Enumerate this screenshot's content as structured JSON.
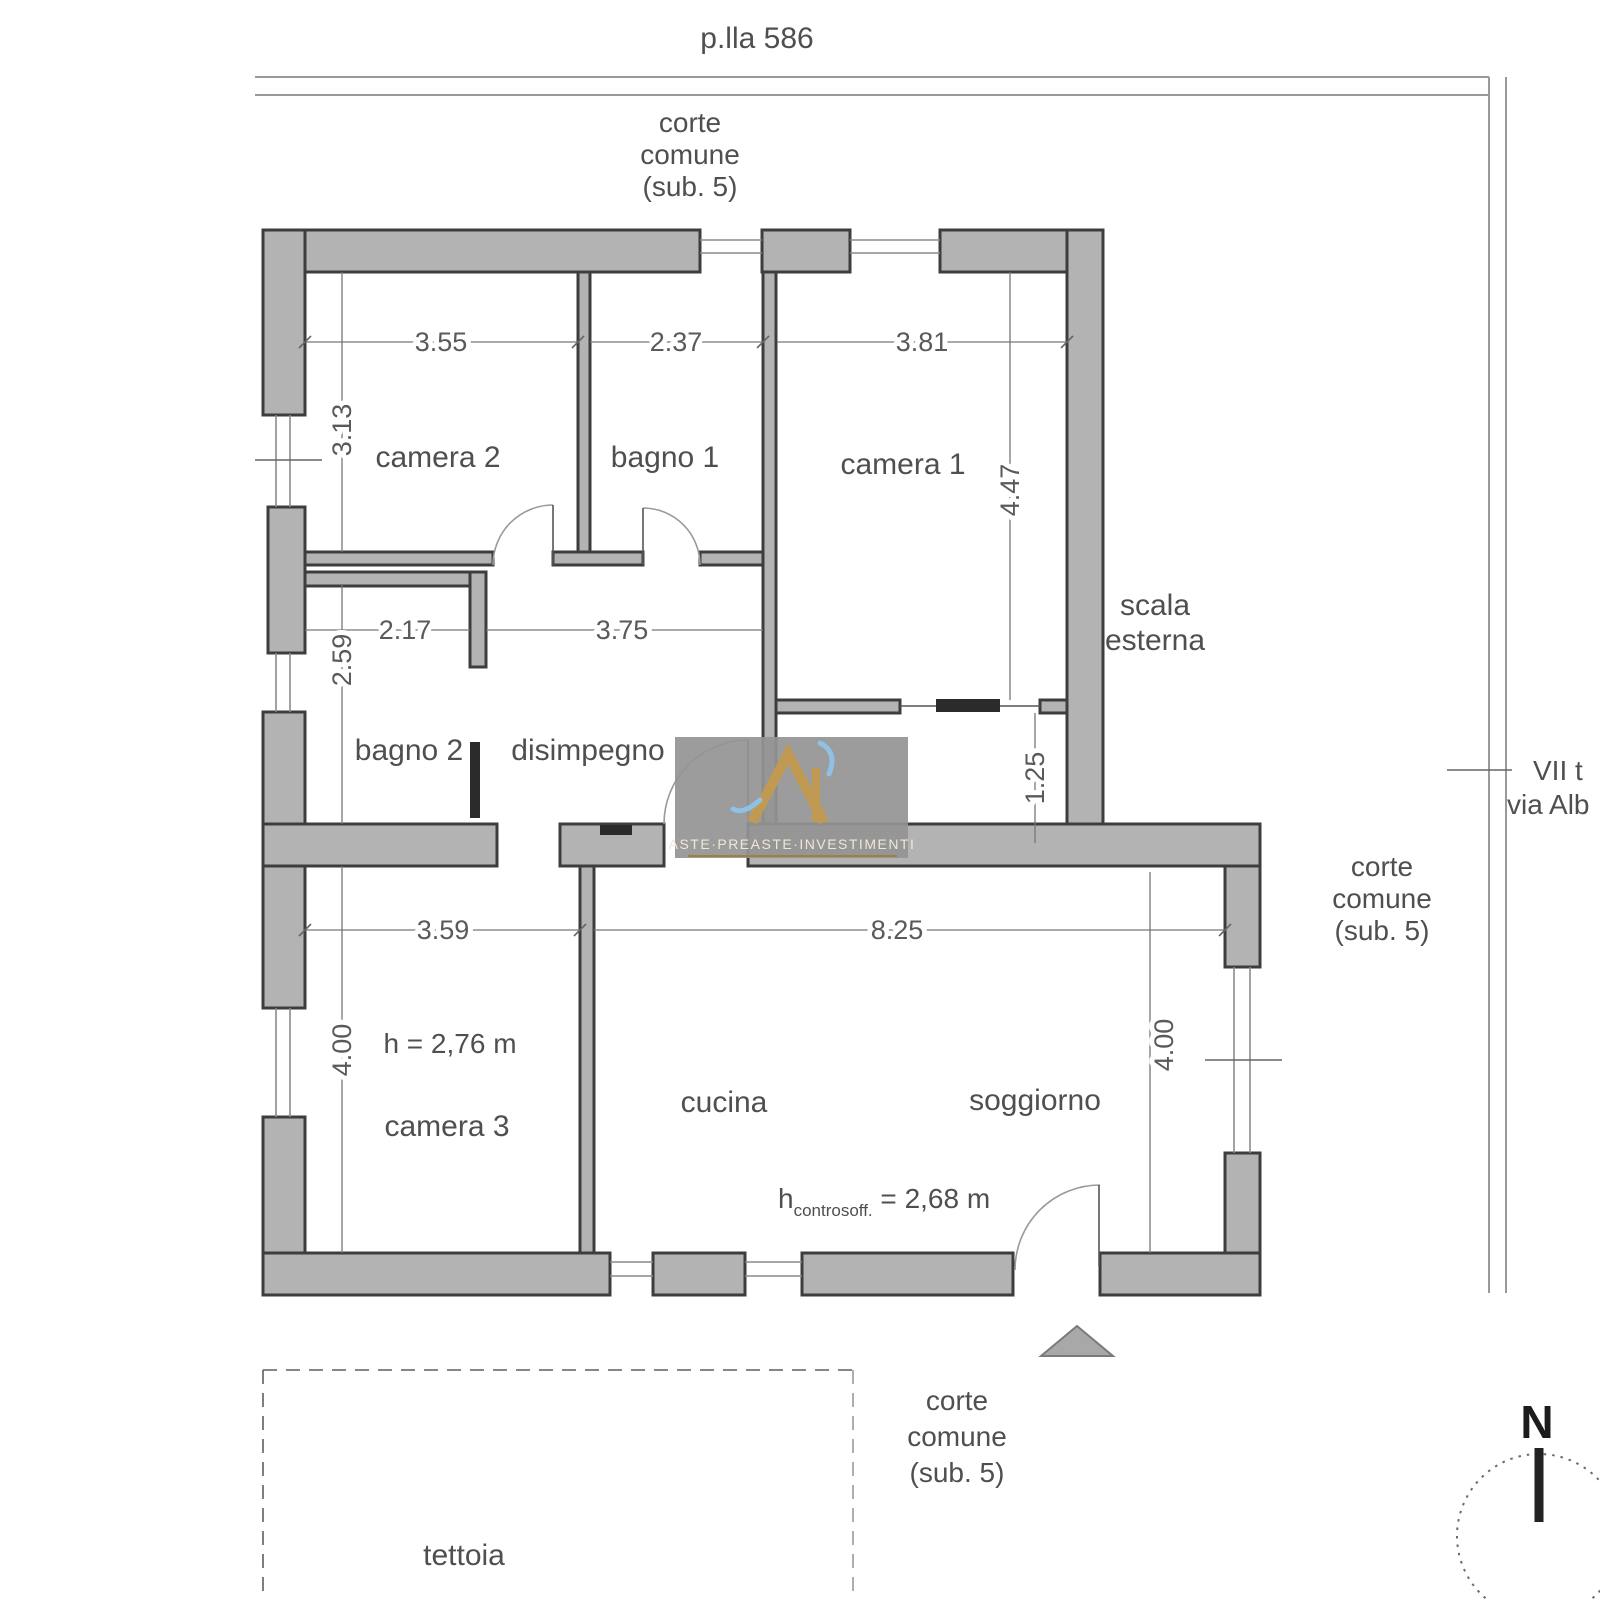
{
  "site": {
    "parcel": "p.lla 586",
    "corte_top": [
      "corte",
      "comune",
      "(sub. 5)"
    ],
    "corte_right": [
      "corte",
      "comune",
      "(sub. 5)"
    ],
    "corte_bottom": [
      "corte",
      "comune",
      "(sub. 5)"
    ],
    "street_line1": "VII t",
    "street_line2": "via Alb",
    "tettoia": "tettoia",
    "compass_north": "N"
  },
  "rooms": {
    "camera2": "camera 2",
    "bagno1": "bagno 1",
    "camera1": "camera 1",
    "bagno2": "bagno 2",
    "disimpegno": "disimpegno",
    "camera3": "camera 3",
    "cucina": "cucina",
    "soggiorno": "soggiorno",
    "scala_line1": "scala",
    "scala_line2": "esterna"
  },
  "dimensions": {
    "camera2_width": "3.55",
    "bagno1_width": "2.37",
    "camera1_width": "3.81",
    "camera2_depth": "3.13",
    "camera1_depth": "4.47",
    "bagno2_width": "2.17",
    "disimpegno_width": "3.75",
    "bagno2_depth": "2.59",
    "vestibule_depth": "1.25",
    "camera3_width": "3.59",
    "living_width": "8.25",
    "camera3_depth": "4.00",
    "soggiorno_depth": "4.00"
  },
  "heights": {
    "camera3_height": "h = 2,76 m",
    "h_symbol": "h",
    "h_subscript": "controsoff.",
    "h_value": " = 2,68 m"
  },
  "watermark": {
    "brand": "ASTE·PREASTE·INVESTIMENTI"
  },
  "colors": {
    "wall_fill": "#b3b3b3",
    "wall_line": "#3d3d3d",
    "dim_line": "#777777",
    "label_text": "#4f4f4f",
    "watermark_bg": "#949494",
    "watermark_gold": "#c09a52",
    "watermark_blue": "#90c0e4"
  }
}
